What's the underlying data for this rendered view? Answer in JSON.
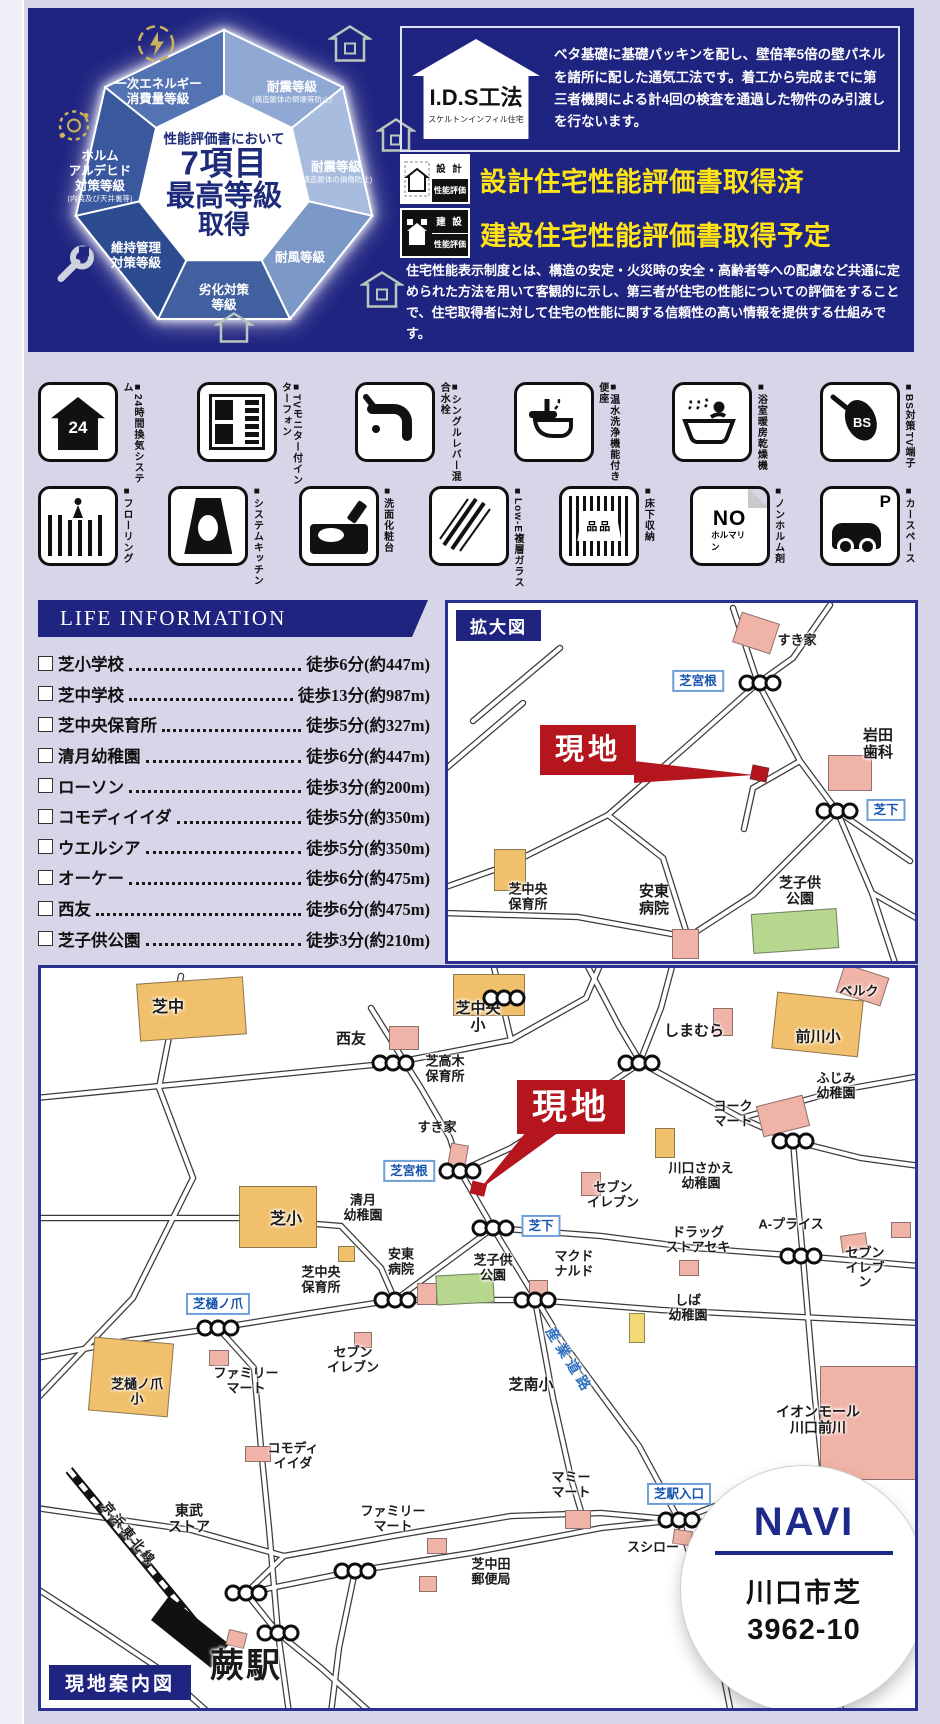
{
  "top": {
    "heptagon": {
      "center": {
        "l1": "性能評価書において",
        "l2": "7項目",
        "l3": "最高等級",
        "l4": "取得"
      },
      "segments": [
        {
          "label": "耐震等級",
          "note": "(構造躯体の倒壊等防止)"
        },
        {
          "label": "耐震等級",
          "note": "(構造躯体の損傷防止)"
        },
        {
          "label": "耐風等級",
          "note": ""
        },
        {
          "label": "劣化対策\n等級",
          "note": ""
        },
        {
          "label": "維持管理\n対策等級",
          "note": ""
        },
        {
          "label": "ホルム\nアルデヒド\n対策等級",
          "note": "(内装及び天井裏等)"
        },
        {
          "label": "一次エネルギー\n消費量等級",
          "note": ""
        }
      ]
    },
    "ids": {
      "title": "I.D.S工法",
      "subtitle": "スケルトンインフィル住宅",
      "body": "ベタ基礎に基礎パッキンを配し、壁倍率5倍の壁パネルを諸所に配した通気工法です。着工から完成までに第三者機関による計4回の検査を通過した物件のみ引渡しを行ないます。"
    },
    "hyoka": {
      "row1": {
        "icon_top": "設 計",
        "icon_bottom": "性能評価",
        "label": "設計住宅性能評価書取得済"
      },
      "row2": {
        "icon_top": "建 設",
        "icon_bottom": "性能評価",
        "label": "建設住宅性能評価書取得予定"
      },
      "body": "住宅性能表示制度とは、構造の安定・火災時の安全・高齢者等への配慮など共通に定められた方法を用いて客観的に示し、第三者が住宅の性能についての評価をすることで、住宅取得者に対して住宅の性能に関する信頼性の高い情報を提供する仕組みです。"
    }
  },
  "amenities": {
    "row1": [
      {
        "label": "■24時間換気システム",
        "glyph": "24"
      },
      {
        "label": "■TVモニター付インターフォン",
        "glyph": ""
      },
      {
        "label": "■シングルレバー混合水栓",
        "glyph": ""
      },
      {
        "label": "■温水洗浄機能付き便座",
        "glyph": ""
      },
      {
        "label": "■浴室暖房乾燥機",
        "glyph": ""
      },
      {
        "label": "■BS対策TV端子",
        "glyph": "BS"
      }
    ],
    "row2": [
      {
        "label": "■フローリング",
        "glyph": ""
      },
      {
        "label": "■システムキッチン",
        "glyph": ""
      },
      {
        "label": "■洗面化粧台",
        "glyph": ""
      },
      {
        "label": "■Low-E複層ガラス",
        "glyph": ""
      },
      {
        "label": "■床下収納",
        "glyph": "品品"
      },
      {
        "label": "■ノンホルム剤",
        "glyph": "NO",
        "glyph2": "ホルマリン"
      },
      {
        "label": "■カースペース",
        "glyph": "P"
      }
    ]
  },
  "life": {
    "title": "LIFE INFORMATION",
    "items": [
      {
        "name": "芝小学校",
        "value": "徒歩6分(約447m)"
      },
      {
        "name": "芝中学校",
        "value": "徒歩13分(約987m)"
      },
      {
        "name": "芝中央保育所",
        "value": "徒歩5分(約327m)"
      },
      {
        "name": "清月幼稚園",
        "value": "徒歩6分(約447m)"
      },
      {
        "name": "ローソン",
        "value": "徒歩3分(約200m)"
      },
      {
        "name": "コモディイイダ",
        "value": "徒歩5分(約350m)"
      },
      {
        "name": "ウエルシア",
        "value": "徒歩5分(約350m)"
      },
      {
        "name": "オーケー",
        "value": "徒歩6分(約475m)"
      },
      {
        "name": "西友",
        "value": "徒歩6分(約475m)"
      },
      {
        "name": "芝子供公園",
        "value": "徒歩3分(約210m)"
      }
    ]
  },
  "emap": {
    "title": "拡大図",
    "genchi": "現地",
    "labels": [
      {
        "x": 349,
        "y": 38,
        "t": "すき家"
      },
      {
        "x": 430,
        "y": 142,
        "t": "岩田\n歯科",
        "fs": 15
      },
      {
        "x": 80,
        "y": 294,
        "t": "芝中央\n保育所"
      },
      {
        "x": 206,
        "y": 298,
        "t": "安東\n病院",
        "fs": 15
      },
      {
        "x": 352,
        "y": 288,
        "t": "芝子供\n公園",
        "fs": 14
      }
    ],
    "intersections": [
      {
        "x": 250,
        "y": 78,
        "t": "芝宮根"
      },
      {
        "x": 438,
        "y": 207,
        "t": "芝下"
      }
    ],
    "lights": [
      {
        "x": 312,
        "y": 80
      },
      {
        "x": 389,
        "y": 208
      }
    ],
    "builds": [
      {
        "x": 288,
        "y": 14,
        "w": 38,
        "h": 30,
        "c": "#f0b3a7",
        "r": 18
      },
      {
        "x": 380,
        "y": 152,
        "w": 42,
        "h": 34,
        "c": "#f0b3a7",
        "r": 0
      },
      {
        "x": 303,
        "y": 163,
        "w": 15,
        "h": 13,
        "c": "#b5161d",
        "r": 12
      },
      {
        "x": 46,
        "y": 246,
        "w": 30,
        "h": 40,
        "c": "#f1c06c",
        "r": 0
      },
      {
        "x": 224,
        "y": 326,
        "w": 25,
        "h": 28,
        "c": "#f0b3a7",
        "r": 0
      },
      {
        "x": 304,
        "y": 308,
        "w": 84,
        "h": 38,
        "c": "#b7d78f",
        "r": -4
      }
    ]
  },
  "bigmap": {
    "caption": "現地案内図",
    "genchi": "現地",
    "navi": {
      "title": "NAVI",
      "addr1": "川口市芝",
      "addr2": "3962-10"
    },
    "labels": [
      {
        "x": 127,
        "y": 40,
        "t": "芝中",
        "fs": 16
      },
      {
        "x": 310,
        "y": 72,
        "t": "西友",
        "fs": 15
      },
      {
        "x": 437,
        "y": 50,
        "t": "芝中央\n小",
        "fs": 15
      },
      {
        "x": 653,
        "y": 64,
        "t": "しまむら",
        "fs": 15
      },
      {
        "x": 818,
        "y": 24,
        "t": "ベルク"
      },
      {
        "x": 777,
        "y": 70,
        "t": "前川小",
        "fs": 15
      },
      {
        "x": 795,
        "y": 118,
        "t": "ふじみ\n幼稚園"
      },
      {
        "x": 404,
        "y": 101,
        "t": "芝高木\n保育所"
      },
      {
        "x": 396,
        "y": 160,
        "t": "すき家"
      },
      {
        "x": 692,
        "y": 146,
        "t": "ヨーク\nマート"
      },
      {
        "x": 660,
        "y": 208,
        "t": "川口さかえ\n幼稚園"
      },
      {
        "x": 322,
        "y": 240,
        "t": "清月\n幼稚園"
      },
      {
        "x": 245,
        "y": 252,
        "t": "芝小",
        "fs": 16
      },
      {
        "x": 572,
        "y": 227,
        "t": "セブン\nイレブン"
      },
      {
        "x": 657,
        "y": 272,
        "t": "ドラッグ\nストアセキ"
      },
      {
        "x": 750,
        "y": 257,
        "t": "A-プライス"
      },
      {
        "x": 824,
        "y": 300,
        "t": "セブン\nイレブン"
      },
      {
        "x": 360,
        "y": 294,
        "t": "安東\n病院"
      },
      {
        "x": 452,
        "y": 300,
        "t": "芝子供\n公園"
      },
      {
        "x": 533,
        "y": 296,
        "t": "マクド\nナルド"
      },
      {
        "x": 280,
        "y": 312,
        "t": "芝中央\n保育所"
      },
      {
        "x": 647,
        "y": 340,
        "t": "しば\n幼稚園"
      },
      {
        "x": 96,
        "y": 424,
        "t": "芝樋ノ爪\n小"
      },
      {
        "x": 205,
        "y": 413,
        "t": "ファミリー\nマート"
      },
      {
        "x": 312,
        "y": 392,
        "t": "セブン\nイレブン"
      },
      {
        "x": 252,
        "y": 488,
        "t": "コモディ\nイイダ"
      },
      {
        "x": 490,
        "y": 418,
        "t": "芝南小",
        "fs": 15
      },
      {
        "x": 148,
        "y": 551,
        "t": "東武\nストア",
        "fs": 14
      },
      {
        "x": 352,
        "y": 551,
        "t": "ファミリー\nマート"
      },
      {
        "x": 450,
        "y": 604,
        "t": "芝中田\n郵便局"
      },
      {
        "x": 530,
        "y": 517,
        "t": "マミー\nマート"
      },
      {
        "x": 612,
        "y": 580,
        "t": "スシロー"
      },
      {
        "x": 777,
        "y": 452,
        "t": "イオンモール\n川口前川",
        "fs": 14
      },
      {
        "x": 205,
        "y": 698,
        "t": "蕨駅",
        "fs": 34,
        "ls": 2
      },
      {
        "x": 88,
        "y": 566,
        "t": "京浜東北線",
        "fs": 12.5,
        "rot": 51,
        "ls": 3
      },
      {
        "x": 528,
        "y": 393,
        "t": "産業道路",
        "fs": 14,
        "rot": 58,
        "ls": 5,
        "color": "#2f6fc0"
      }
    ],
    "intersections": [
      {
        "x": 368,
        "y": 203,
        "t": "芝宮根"
      },
      {
        "x": 500,
        "y": 258,
        "t": "芝下"
      },
      {
        "x": 177,
        "y": 336,
        "t": "芝樋ノ爪"
      },
      {
        "x": 638,
        "y": 526,
        "t": "芝駅入口"
      }
    ],
    "lights": [
      {
        "x": 352,
        "y": 95
      },
      {
        "x": 598,
        "y": 95
      },
      {
        "x": 463,
        "y": 30
      },
      {
        "x": 752,
        "y": 173
      },
      {
        "x": 419,
        "y": 203
      },
      {
        "x": 452,
        "y": 260
      },
      {
        "x": 354,
        "y": 332
      },
      {
        "x": 494,
        "y": 332
      },
      {
        "x": 760,
        "y": 288
      },
      {
        "x": 177,
        "y": 360
      },
      {
        "x": 638,
        "y": 552
      },
      {
        "x": 314,
        "y": 603
      },
      {
        "x": 205,
        "y": 625
      },
      {
        "x": 237,
        "y": 665
      }
    ],
    "builds": [
      {
        "x": 97,
        "y": 12,
        "w": 105,
        "h": 56,
        "c": "#f1c06c",
        "r": -4
      },
      {
        "x": 412,
        "y": 6,
        "w": 70,
        "h": 40,
        "c": "#f1c06c",
        "r": 0
      },
      {
        "x": 348,
        "y": 58,
        "w": 28,
        "h": 22,
        "c": "#f0b3a7",
        "r": 0
      },
      {
        "x": 733,
        "y": 28,
        "w": 85,
        "h": 55,
        "c": "#f1c06c",
        "r": 6
      },
      {
        "x": 798,
        "y": 2,
        "w": 45,
        "h": 28,
        "c": "#f0b3a7",
        "r": 18
      },
      {
        "x": 672,
        "y": 40,
        "w": 18,
        "h": 26,
        "c": "#f0b3a7",
        "r": 0
      },
      {
        "x": 718,
        "y": 132,
        "w": 46,
        "h": 30,
        "c": "#f0b3a7",
        "r": -14
      },
      {
        "x": 614,
        "y": 160,
        "w": 18,
        "h": 28,
        "c": "#f1c06c",
        "r": 0
      },
      {
        "x": 408,
        "y": 176,
        "w": 16,
        "h": 22,
        "c": "#f0b3a7",
        "r": 10
      },
      {
        "x": 198,
        "y": 218,
        "w": 76,
        "h": 60,
        "c": "#f1c06c",
        "r": 0
      },
      {
        "x": 540,
        "y": 204,
        "w": 18,
        "h": 22,
        "c": "#f0b3a7",
        "r": 0
      },
      {
        "x": 638,
        "y": 292,
        "w": 18,
        "h": 14,
        "c": "#f0b3a7",
        "r": 0
      },
      {
        "x": 800,
        "y": 266,
        "w": 24,
        "h": 15,
        "c": "#f0b3a7",
        "r": -8
      },
      {
        "x": 850,
        "y": 254,
        "w": 18,
        "h": 14,
        "c": "#f0b3a7",
        "r": 0
      },
      {
        "x": 376,
        "y": 315,
        "w": 18,
        "h": 20,
        "c": "#f0b3a7",
        "r": 0
      },
      {
        "x": 395,
        "y": 306,
        "w": 56,
        "h": 28,
        "c": "#b7d78f",
        "r": -3
      },
      {
        "x": 488,
        "y": 312,
        "w": 17,
        "h": 18,
        "c": "#f0b3a7",
        "r": 0
      },
      {
        "x": 297,
        "y": 278,
        "w": 15,
        "h": 14,
        "c": "#f1c06c",
        "r": 0
      },
      {
        "x": 588,
        "y": 345,
        "w": 14,
        "h": 28,
        "c": "#f3d974",
        "r": 0
      },
      {
        "x": 50,
        "y": 372,
        "w": 78,
        "h": 72,
        "c": "#f1c06c",
        "r": 5
      },
      {
        "x": 168,
        "y": 382,
        "w": 18,
        "h": 14,
        "c": "#f0b3a7",
        "r": 0
      },
      {
        "x": 313,
        "y": 364,
        "w": 16,
        "h": 14,
        "c": "#f0b3a7",
        "r": 0
      },
      {
        "x": 204,
        "y": 478,
        "w": 24,
        "h": 14,
        "c": "#f0b3a7",
        "r": 0
      },
      {
        "x": 524,
        "y": 542,
        "w": 24,
        "h": 17,
        "c": "#f0b3a7",
        "r": 0
      },
      {
        "x": 632,
        "y": 562,
        "w": 17,
        "h": 13,
        "c": "#f0b3a7",
        "r": 8
      },
      {
        "x": 386,
        "y": 570,
        "w": 18,
        "h": 14,
        "c": "#f0b3a7",
        "r": 0
      },
      {
        "x": 378,
        "y": 608,
        "w": 16,
        "h": 14,
        "c": "#f0b3a7",
        "r": 0
      },
      {
        "x": 779,
        "y": 398,
        "w": 95,
        "h": 112,
        "c": "#f0b3a7",
        "r": 0
      },
      {
        "x": 186,
        "y": 663,
        "w": 17,
        "h": 14,
        "c": "#f0b3a7",
        "r": 14
      }
    ]
  }
}
